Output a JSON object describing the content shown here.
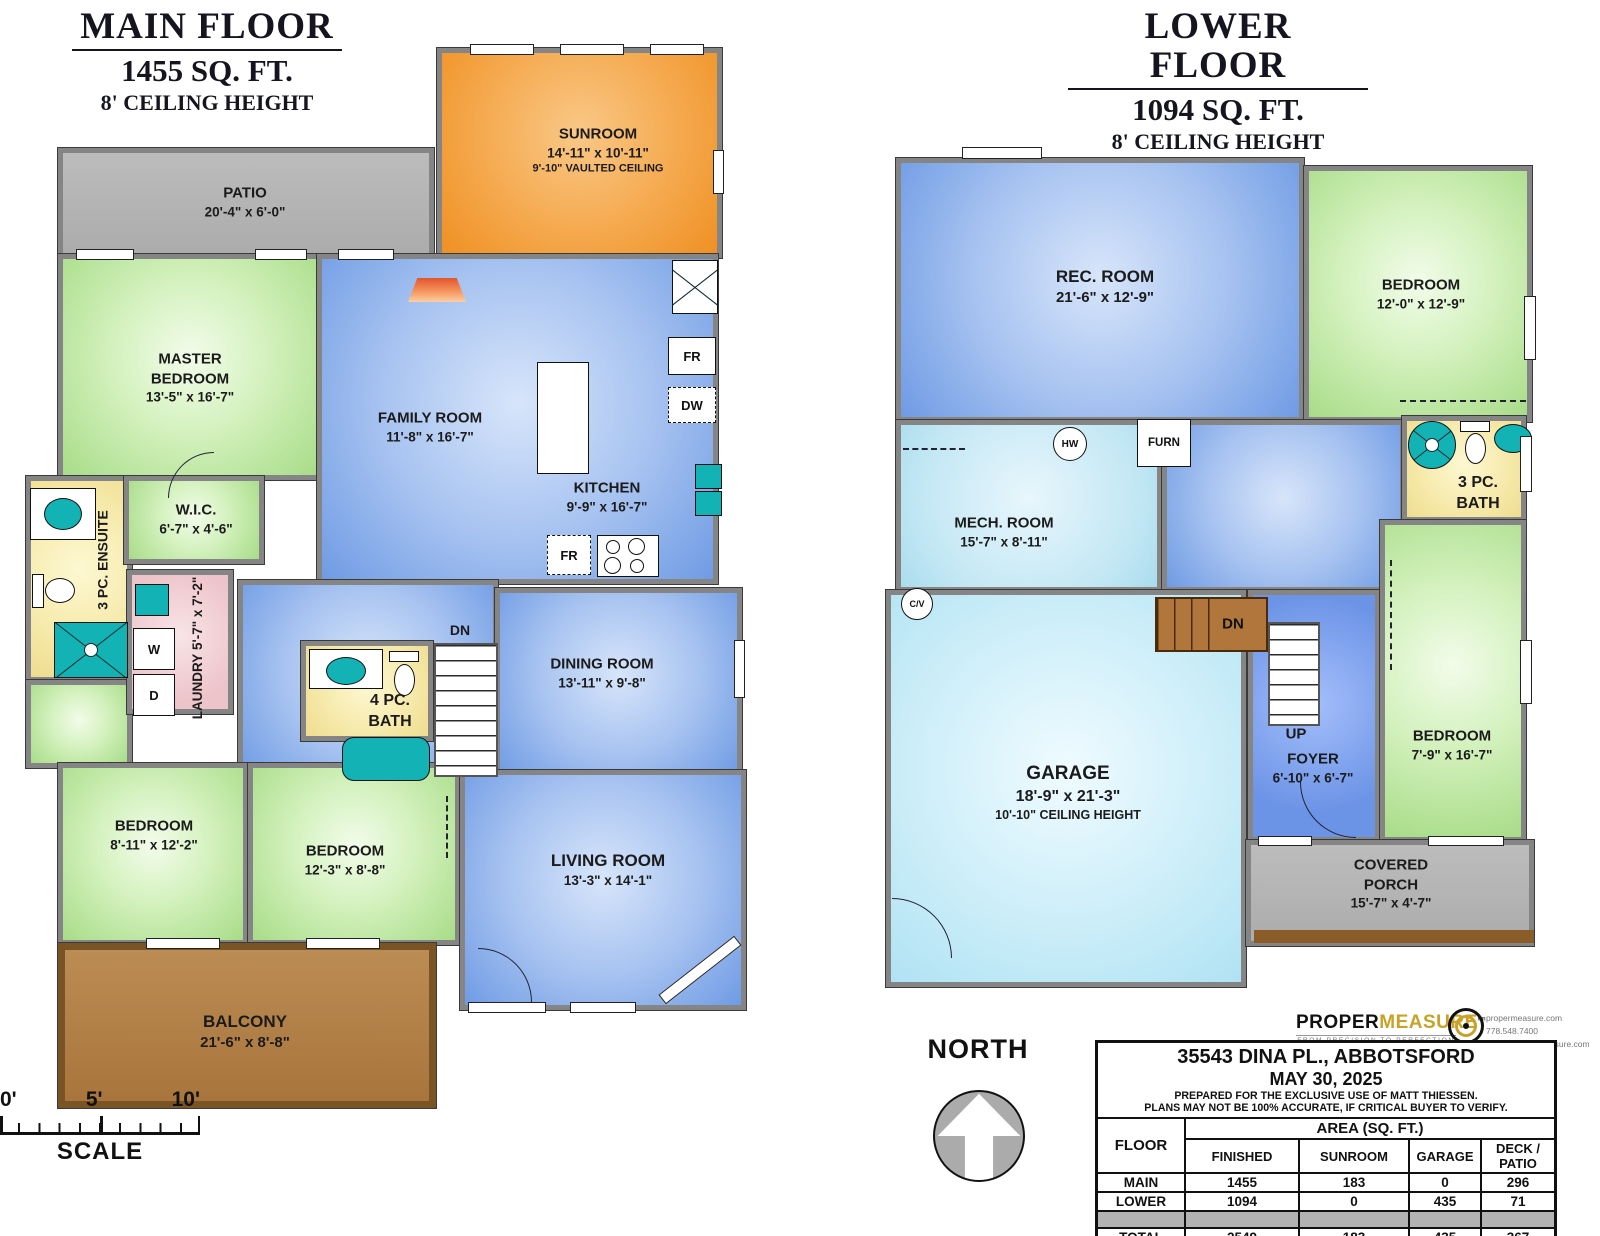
{
  "main_floor": {
    "title": "MAIN FLOOR",
    "sqft": "1455 SQ. FT.",
    "ceiling": "8' CEILING HEIGHT",
    "patio": {
      "name": "PATIO",
      "dims": "20'-4\" x 6'-0\""
    },
    "sunroom": {
      "name": "SUNROOM",
      "dims": "14'-11\" x 10'-11\"",
      "extra": "9'-10\" VAULTED CEILING"
    },
    "master": {
      "name": "MASTER BEDROOM",
      "dims": "13'-5\" x 16'-7\""
    },
    "family": {
      "name": "FAMILY ROOM",
      "dims": "11'-8\" x 16'-7\""
    },
    "kitchen": {
      "name": "KITCHEN",
      "dims": "9'-9\" x 16'-7\""
    },
    "wic": {
      "name": "W.I.C.",
      "dims": "6'-7\" x 4'-6\""
    },
    "ensuite": {
      "name": "3 PC. ENSUITE"
    },
    "laundry": {
      "name": "LAUNDRY",
      "dims": "5'-7\" x 7'-2\""
    },
    "bath": {
      "name": "4 PC. BATH"
    },
    "dining": {
      "name": "DINING ROOM",
      "dims": "13'-11\" x 9'-8\""
    },
    "bedroom2": {
      "name": "BEDROOM",
      "dims": "8'-11\" x 12'-2\""
    },
    "bedroom3": {
      "name": "BEDROOM",
      "dims": "12'-3\" x 8'-8\""
    },
    "living": {
      "name": "LIVING ROOM",
      "dims": "13'-3\" x 14'-1\""
    },
    "balcony": {
      "name": "BALCONY",
      "dims": "21'-6\" x 8'-8\""
    },
    "dn": "DN"
  },
  "lower_floor": {
    "title": "LOWER FLOOR",
    "sqft": "1094 SQ. FT.",
    "ceiling": "8' CEILING HEIGHT",
    "rec": {
      "name": "REC. ROOM",
      "dims": "21'-6\" x 12'-9\""
    },
    "bedroom1": {
      "name": "BEDROOM",
      "dims": "12'-0\" x 12'-9\""
    },
    "mech": {
      "name": "MECH. ROOM",
      "dims": "15'-7\" x 8'-11\""
    },
    "bath": {
      "name": "3 PC. BATH"
    },
    "garage": {
      "name": "GARAGE",
      "dims": "18'-9\" x 21'-3\"",
      "extra": "10'-10\" CEILING HEIGHT"
    },
    "foyer": {
      "name": "FOYER",
      "dims": "6'-10\" x 6'-7\""
    },
    "bedroom2": {
      "name": "BEDROOM",
      "dims": "7'-9\" x 16'-7\""
    },
    "porch": {
      "name": "COVERED PORCH",
      "dims": "15'-7\" x 4'-7\""
    },
    "up": "UP",
    "dn": "DN"
  },
  "appliances": {
    "fridge": "FR",
    "dishwasher": "DW",
    "washer": "W",
    "dryer": "D",
    "hot_water": "HW",
    "furnace": "FURN",
    "central_vac": "C/V"
  },
  "compass": {
    "label": "NORTH"
  },
  "scale_bar": {
    "t0": "0'",
    "t5": "5'",
    "t10": "10'",
    "caption": "SCALE"
  },
  "logo": {
    "part1": "PROPER",
    "part2": "MEASURE",
    "tm": "tm",
    "tagline": "FROM PRECISION TO PERFECTION",
    "website": "propermeasure.com",
    "phone": "778.548.7400",
    "email": "frank@propermeasure.com"
  },
  "info_table": {
    "address": "35543 DINA PL., ABBOTSFORD",
    "date": "MAY 30, 2025",
    "note1": "PREPARED FOR THE EXCLUSIVE USE OF MATT THIESSEN.",
    "note2": "PLANS MAY NOT BE 100% ACCURATE, IF CRITICAL BUYER TO VERIFY.",
    "floor_header": "FLOOR",
    "area_header": "AREA (SQ. FT.)",
    "col_headers": [
      "FINISHED",
      "SUNROOM",
      "GARAGE",
      "DECK / PATIO"
    ],
    "rows": [
      {
        "floor": "MAIN",
        "values": [
          "1455",
          "183",
          "0",
          "296"
        ]
      },
      {
        "floor": "LOWER",
        "values": [
          "1094",
          "0",
          "435",
          "71"
        ]
      }
    ],
    "total": {
      "floor": "TOTAL",
      "values": [
        "2549",
        "183",
        "435",
        "367"
      ]
    }
  },
  "colors": {
    "wall": "#858585",
    "bedroom_green": "#a8dc88",
    "living_blue": "#6f9be4",
    "garage_blue": "#b0e2f3",
    "bath_yellow": "#f4e6a2",
    "sunroom_orange": "#f5a94e",
    "laundry_pink": "#edc4ca",
    "balcony_brown": "#a8753c",
    "fixture_teal": "#13b2b5"
  }
}
